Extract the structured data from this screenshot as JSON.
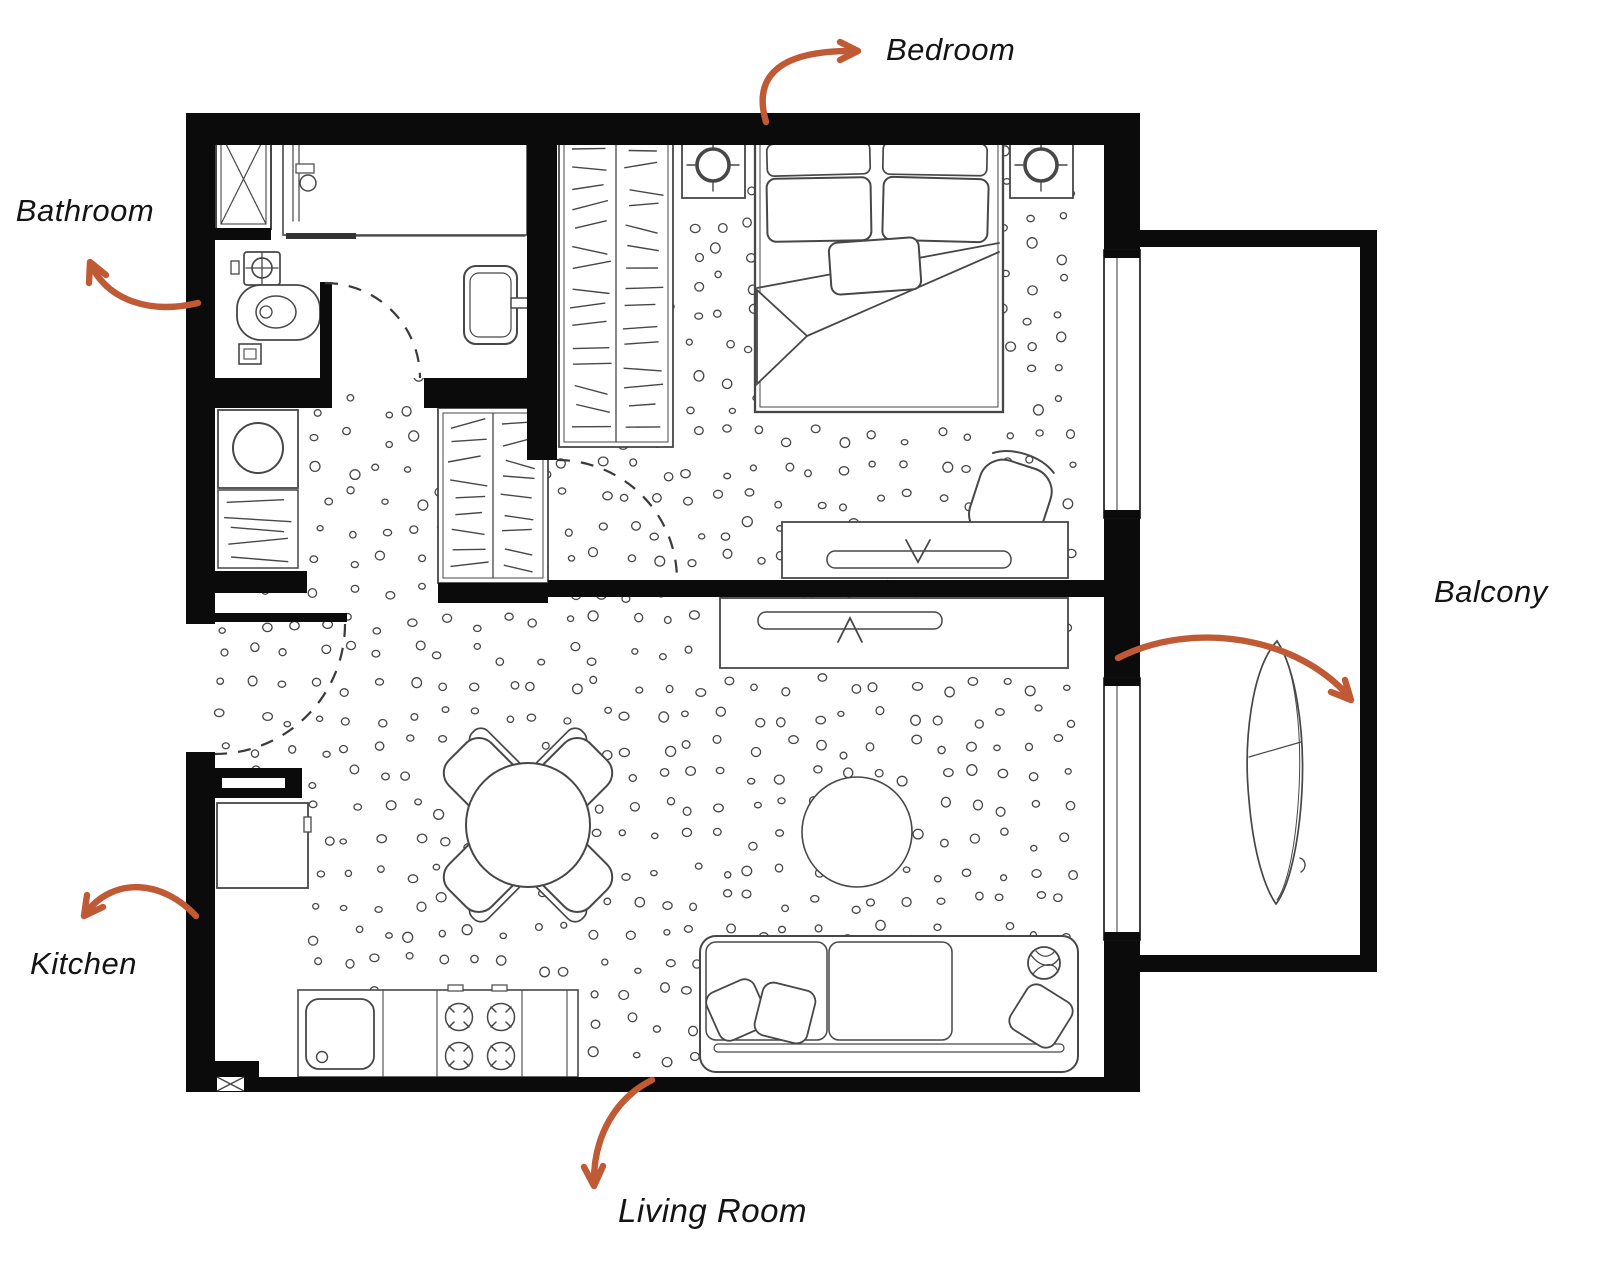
{
  "colors": {
    "accent": "#C05A35",
    "wall": "#0B0B0B",
    "line": "#474747"
  },
  "labels": {
    "bathroom": "Bathroom",
    "bedroom": "Bedroom",
    "balcony": "Balcony",
    "kitchen": "Kitchen",
    "living_room": "Living Room"
  }
}
